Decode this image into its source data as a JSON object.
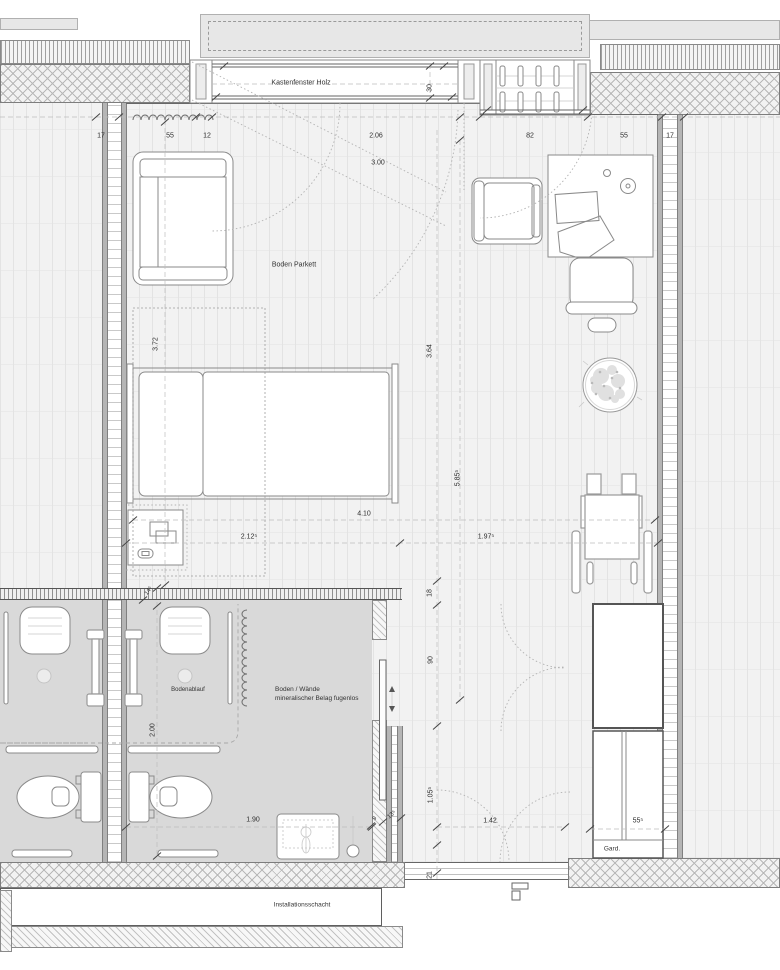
{
  "drawing": {
    "type": "architectural-floor-plan",
    "labels": {
      "kastenfenster_holz": "Kastenfenster Holz",
      "boden_parkett": "Boden Parkett",
      "bodenablauf": "Bodenablauf",
      "belag_line1": "Boden / Wände",
      "belag_line2": "mineralischer Belag fugenlos",
      "garderobe": "Gard.",
      "installationsschacht": "Installationsschacht"
    },
    "dimension_labels": [
      {
        "text": "17",
        "x": 101,
        "y": 136
      },
      {
        "text": "55",
        "x": 170,
        "y": 136
      },
      {
        "text": "12",
        "x": 207,
        "y": 136
      },
      {
        "text": "2.06",
        "x": 376,
        "y": 136
      },
      {
        "text": "82",
        "x": 530,
        "y": 136
      },
      {
        "text": "55",
        "x": 624,
        "y": 136
      },
      {
        "text": "17",
        "x": 670,
        "y": 136
      },
      {
        "text": "3.00",
        "x": 378,
        "y": 163
      },
      {
        "text": "30",
        "x": 430,
        "y": 88,
        "rot": -90
      },
      {
        "text": "3.72",
        "x": 156,
        "y": 344,
        "rot": -90
      },
      {
        "text": "3.64",
        "x": 430,
        "y": 351,
        "rot": -90
      },
      {
        "text": "5.85⁵",
        "x": 458,
        "y": 478,
        "rot": -90
      },
      {
        "text": "4.10",
        "x": 364,
        "y": 514
      },
      {
        "text": "2.12⁵",
        "x": 249,
        "y": 537
      },
      {
        "text": "1.97⁵",
        "x": 486,
        "y": 537
      },
      {
        "text": "18",
        "x": 430,
        "y": 593,
        "rot": -90
      },
      {
        "text": "14⁵",
        "x": 149,
        "y": 591,
        "rot": -55,
        "fs": 6
      },
      {
        "text": "2.00",
        "x": 153,
        "y": 730,
        "rot": -90
      },
      {
        "text": "90",
        "x": 431,
        "y": 660,
        "rot": -90
      },
      {
        "text": "1.05⁵",
        "x": 431,
        "y": 795,
        "rot": -90
      },
      {
        "text": "1.42",
        "x": 490,
        "y": 821
      },
      {
        "text": "1.90",
        "x": 253,
        "y": 820
      },
      {
        "text": "9",
        "x": 375,
        "y": 819,
        "rot": -40,
        "fs": 6
      },
      {
        "text": "13⁵",
        "x": 392,
        "y": 815,
        "rot": -40,
        "fs": 6
      },
      {
        "text": "55⁵",
        "x": 638,
        "y": 821
      },
      {
        "text": "21",
        "x": 430,
        "y": 875,
        "rot": -90
      }
    ]
  },
  "colors": {
    "floor_parquet": "#f2f2f2",
    "floor_bathroom": "#d9d9d9",
    "wall_fill": "#e7e7e7",
    "line": "#777777",
    "text": "#333333"
  }
}
